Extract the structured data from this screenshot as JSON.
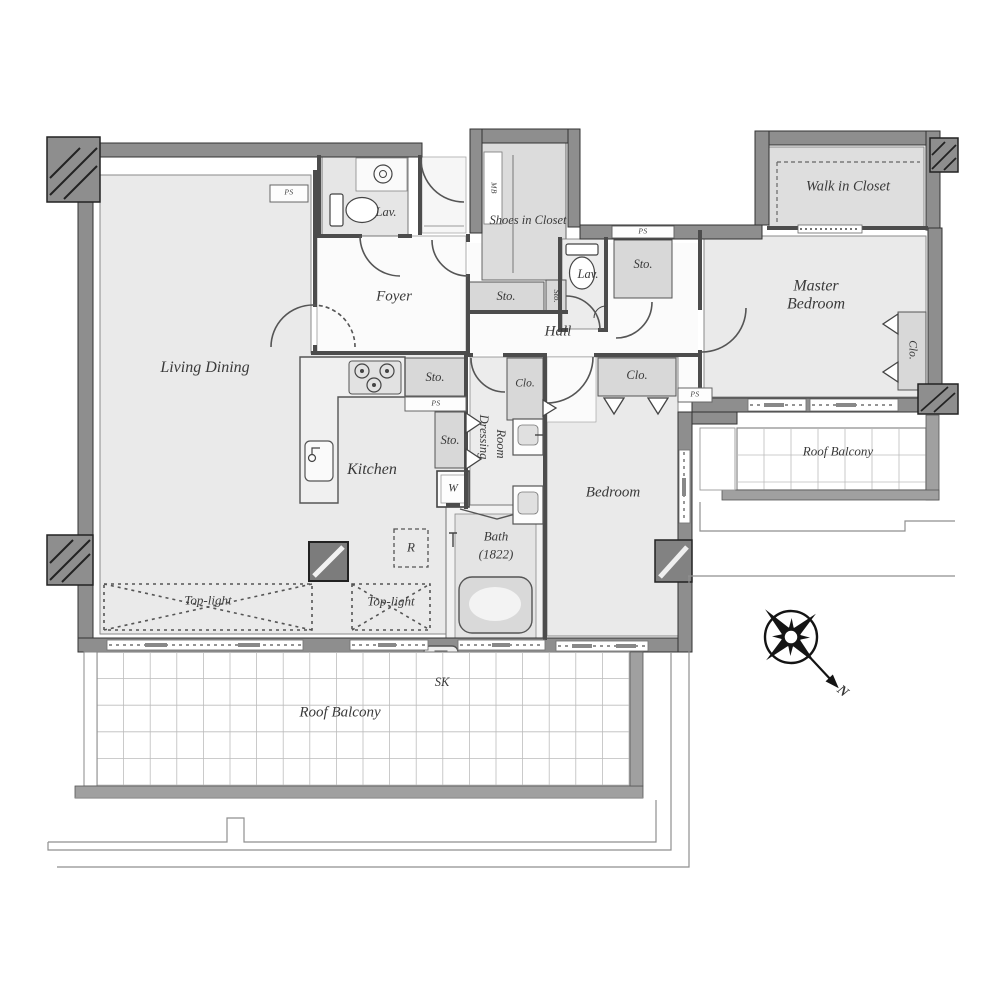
{
  "plan": {
    "rooms": {
      "living_dining": "Living Dining",
      "kitchen": "Kitchen",
      "foyer": "Foyer",
      "hall": "Hall",
      "master_bedroom": "Master Bedroom",
      "bedroom": "Bedroom",
      "walk_in_closet": "Walk in Closet",
      "shoes_in_closet": "Shoes in Closet",
      "dressing_line1": "Dressing",
      "dressing_line2": "Room",
      "bath": "Bath",
      "bath_size": "(1822)",
      "lavatory": "Lav."
    },
    "compact": {
      "storage": "Sto.",
      "closet": "Clo.",
      "washer": "W",
      "refrigerator": "R",
      "slop_sink": "SK",
      "pipe_space": "PS",
      "meter_box": "MB"
    },
    "outdoor": {
      "roof_balcony": "Roof Balcony",
      "top_light": "Top-light"
    },
    "compass": {
      "north": "N"
    }
  }
}
